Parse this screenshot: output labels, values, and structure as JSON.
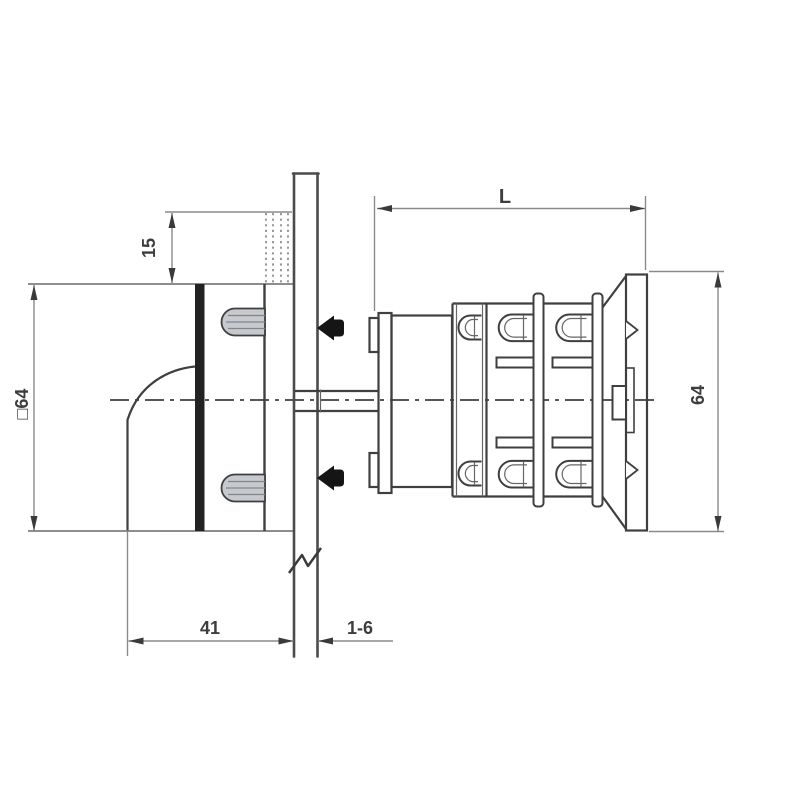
{
  "dimensions": {
    "knob_height": "15",
    "handle_square": "□64",
    "handle_depth": "41",
    "panel_thickness": "1-6",
    "body_length": "L",
    "body_height": "64"
  },
  "colors": {
    "background": "#ffffff",
    "object_line": "#3f3f3f",
    "heavy_line": "#222222",
    "panel_line": "#4b4b4b",
    "dimension_line": "#8a8a8a",
    "text": "#3d3d3d",
    "screw_fill": "#151515",
    "stud_fill": "#c6c9cd"
  }
}
